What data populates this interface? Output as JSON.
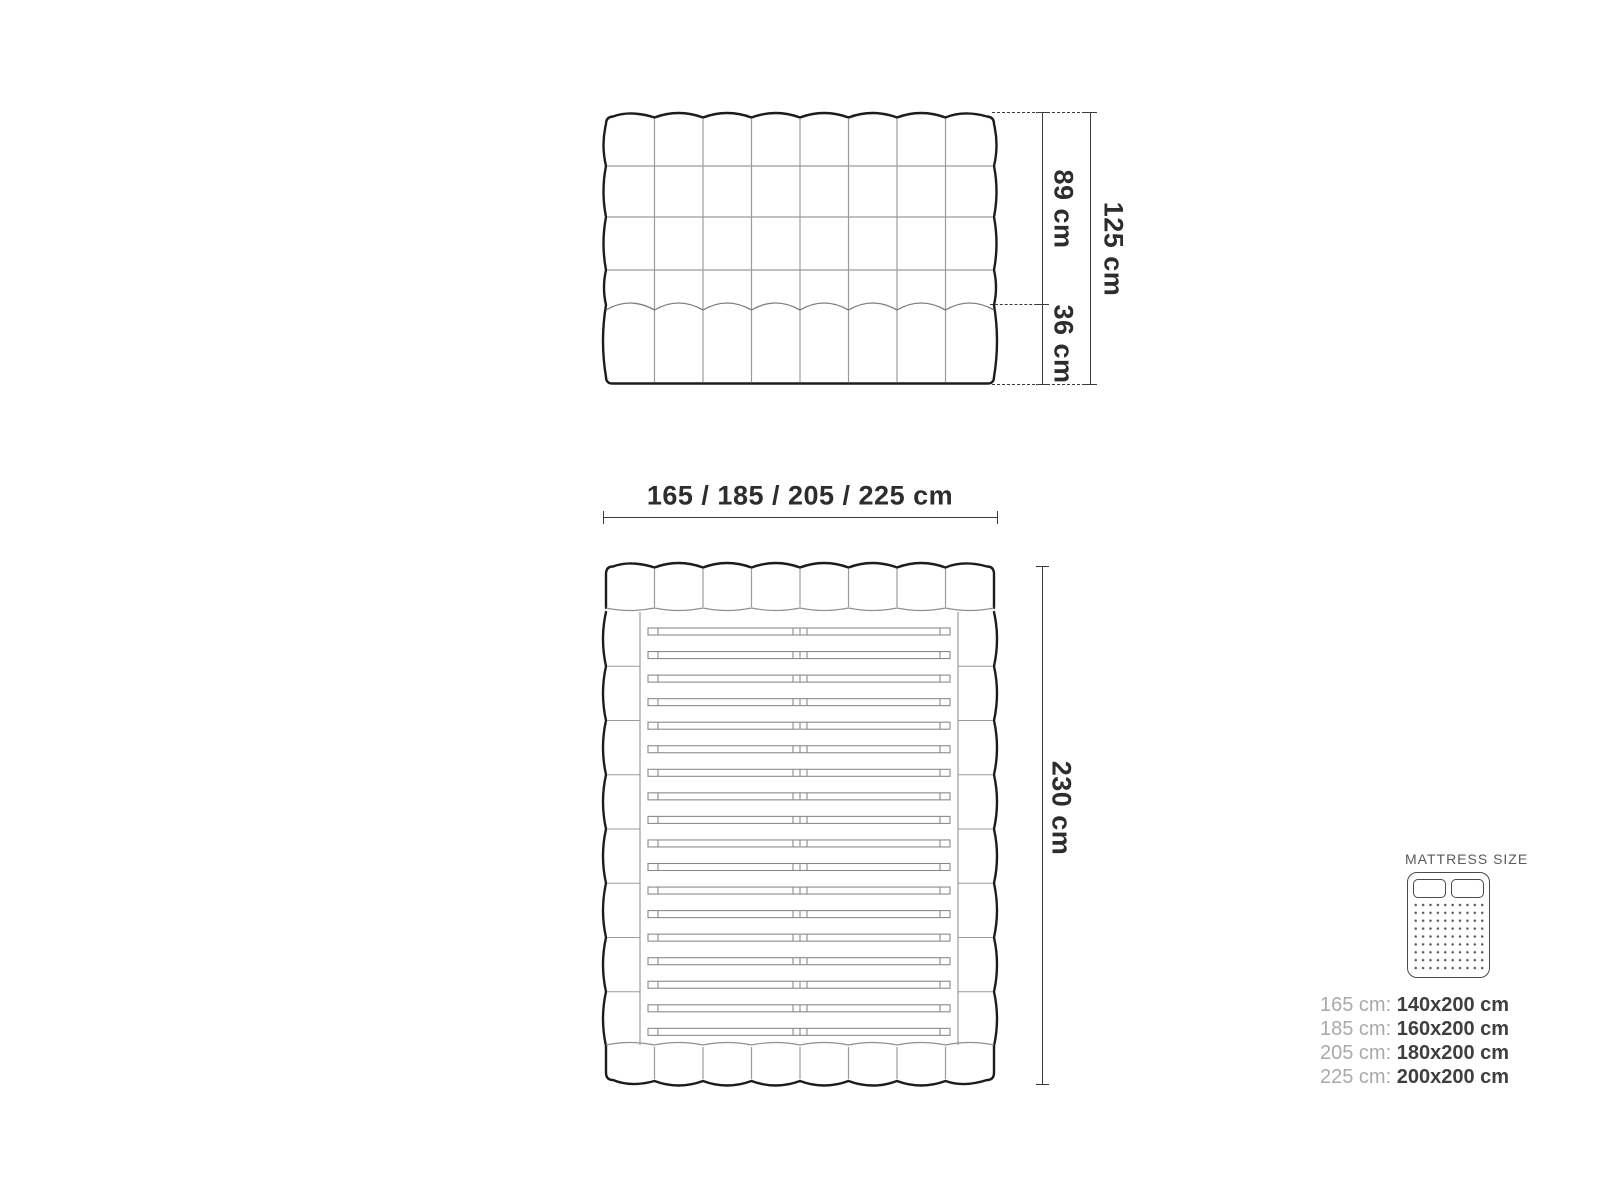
{
  "front_view": {
    "upper_height": "89 cm",
    "lower_height": "36 cm",
    "total_height": "125 cm"
  },
  "top_view": {
    "width_options": "165 / 185 / 205 / 225 cm",
    "length": "230 cm"
  },
  "legend": {
    "title": "MATTRESS SIZE",
    "icon": "mattress-top-view-icon",
    "sizes": [
      {
        "frame": "165 cm:",
        "mattress": "140x200 cm"
      },
      {
        "frame": "185 cm:",
        "mattress": "160x200 cm"
      },
      {
        "frame": "205 cm:",
        "mattress": "180x200 cm"
      },
      {
        "frame": "225 cm:",
        "mattress": "200x200 cm"
      }
    ]
  },
  "colors": {
    "outline": "#1c1c1c",
    "inner_line": "#9b9b9b",
    "slat_line": "#8a8a8a",
    "dimension": "#3c3c3c",
    "legend_label": "#a9a9a9",
    "legend_value": "#3f3f3f"
  }
}
